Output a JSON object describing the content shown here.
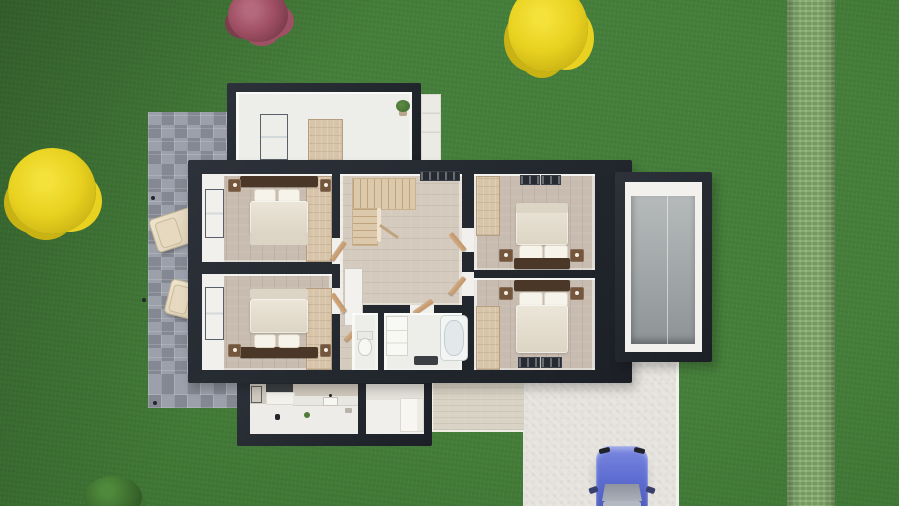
{
  "scene": {
    "description": "Top-down 3D architectural render of a house upper-floor cutaway plan set in a lawn, with stone patio, garage, driveway and a parked blue car",
    "view": "top-down",
    "image_type": "3d-floorplan-render"
  },
  "palette": {
    "grass": "#3e7a33",
    "hedge": "#7ca465",
    "wall": "#23282f",
    "room_white": "#f1f0ec",
    "floor_white": "#edeeea",
    "wood_bedroom": "#c8bcb0",
    "wood_landing": "#d4cabd",
    "paver": "#969ba6",
    "wardrobe": "#d8c4a9",
    "stair": "#dcc9ab",
    "stair_line": "#bfa37e",
    "duvet": "#ece6d9",
    "duvet_shadow": "#dcd4c4",
    "pillow": "#f6f3ea",
    "headboard": "#4a3727",
    "nightstand": "#74563d",
    "vent": "#272b31",
    "tub": "#f3f5f4",
    "tub_inner": "#e3e9ea",
    "tub_line": "#c3cdcf",
    "mat": "#3b3f44",
    "garage_floor": "#a6abad",
    "garage_floor_dark": "#8e9496",
    "driveway": "#e8e5e0",
    "terrace": "#d9d3c5",
    "kitchen_wall": "#d0c9bd",
    "counter_top": "#3c3f42",
    "car_body": "#5e6ed2",
    "car_body_dark": "#4a58b8",
    "car_glass": "#a7abb5",
    "bush_red": "#a05064",
    "bush_red_dark": "#7e3c4e",
    "bush_red_light": "#b56a7c",
    "bush_yellow": "#e8d11f",
    "bush_yellow_dark": "#c9b214",
    "bush_yellow_light": "#f4e23a",
    "bush_green": "#3f7030",
    "bush_green_dark": "#2f5724",
    "bush_green_light": "#4f8a3c"
  },
  "garden": {
    "lawn_color": "#3e7a33",
    "hedge": {
      "side": "right",
      "color": "#7ca465"
    },
    "plants": [
      {
        "name": "red-bush",
        "position": "top-left",
        "color": "#a05064"
      },
      {
        "name": "yellow-tree",
        "position": "top-right",
        "color": "#e8d11f"
      },
      {
        "name": "yellow-bush",
        "position": "middle-left",
        "color": "#e8d11f"
      },
      {
        "name": "green-bush",
        "position": "bottom-left",
        "color": "#3f7030"
      }
    ]
  },
  "house": {
    "wall_color": "#23282f",
    "rooms": [
      {
        "name": "utility-room",
        "area": "top-annex",
        "floor": "white",
        "furniture": [
          "shelving-unit",
          "plant"
        ]
      },
      {
        "name": "bedroom-top-left",
        "floor": "wood",
        "window": "west",
        "furniture": [
          "double-bed",
          "two-nightstands",
          "wardrobe"
        ]
      },
      {
        "name": "bedroom-bottom-left",
        "floor": "wood",
        "window": "west",
        "furniture": [
          "double-bed",
          "two-nightstands",
          "wardrobe"
        ]
      },
      {
        "name": "landing",
        "floor": "light-wood",
        "furniture": [
          "u-staircase",
          "closet",
          "vent-grille"
        ]
      },
      {
        "name": "wc",
        "floor": "white",
        "furniture": [
          "toilet"
        ]
      },
      {
        "name": "bathroom",
        "floor": "white",
        "furniture": [
          "bathtub",
          "vanity-shelf",
          "bath-mat"
        ]
      },
      {
        "name": "bedroom-top-right",
        "floor": "wood",
        "furniture": [
          "double-bed",
          "two-nightstands",
          "wardrobe",
          "floor-vents"
        ]
      },
      {
        "name": "bedroom-bottom-right",
        "floor": "wood",
        "furniture": [
          "double-bed",
          "two-nightstands",
          "wardrobe",
          "floor-vents"
        ]
      },
      {
        "name": "garage",
        "floor": "concrete"
      },
      {
        "name": "kitchen",
        "area": "bottom-annex",
        "furniture": [
          "counter",
          "sink",
          "worktop"
        ]
      },
      {
        "name": "pantry",
        "area": "bottom-annex",
        "furniture": [
          "cabinet"
        ]
      }
    ]
  },
  "exterior": {
    "patio": {
      "material": "stone-pavers",
      "side": "left",
      "furniture": [
        "lounge-chair",
        "lounge-chair",
        "garden-lights"
      ]
    },
    "terrace": {
      "material": "beige-pavers",
      "position": "bottom-center"
    },
    "driveway": {
      "material": "concrete",
      "position": "bottom-right"
    },
    "vehicle": {
      "type": "car",
      "color": "#5e6ed2",
      "location": "driveway",
      "heading": "north"
    }
  }
}
